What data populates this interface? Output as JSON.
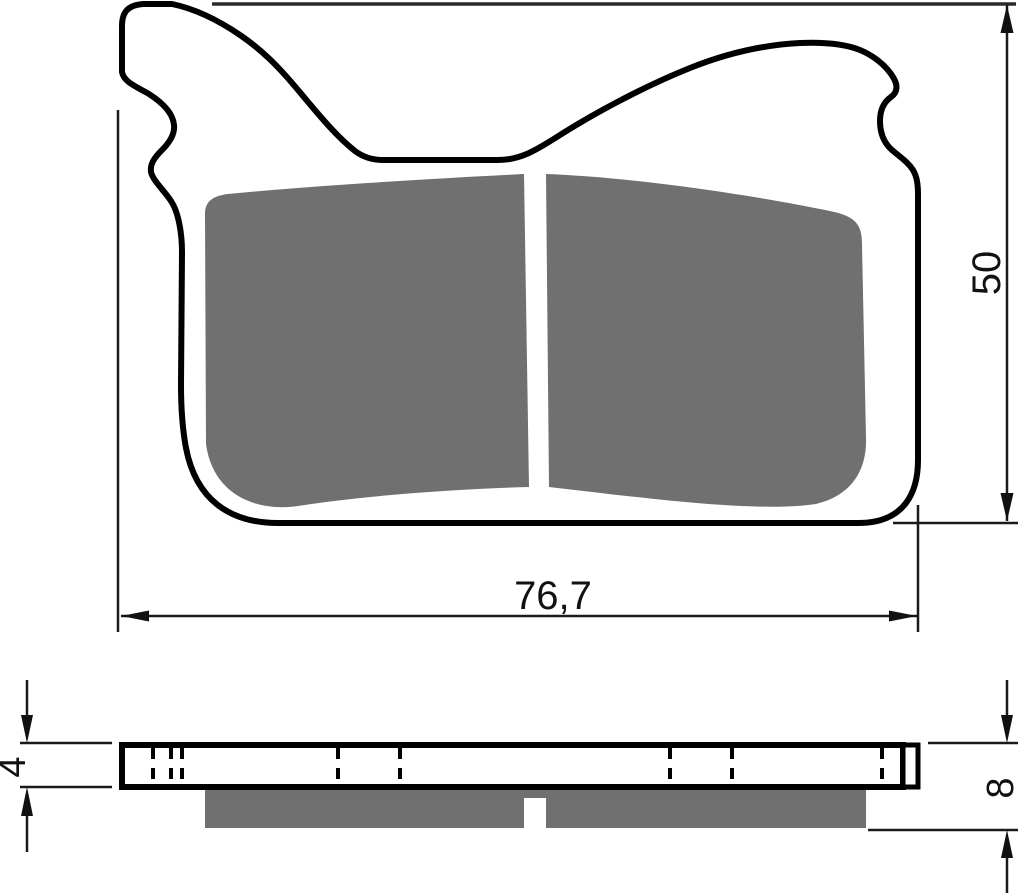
{
  "drawing": {
    "dimension_labels": {
      "overall_width": "76,7",
      "overall_height": "50",
      "backing_plate_thickness": "4",
      "total_thickness": "8"
    },
    "colors": {
      "line": "#111111",
      "friction_material": "#707070",
      "background": "#ffffff"
    }
  }
}
